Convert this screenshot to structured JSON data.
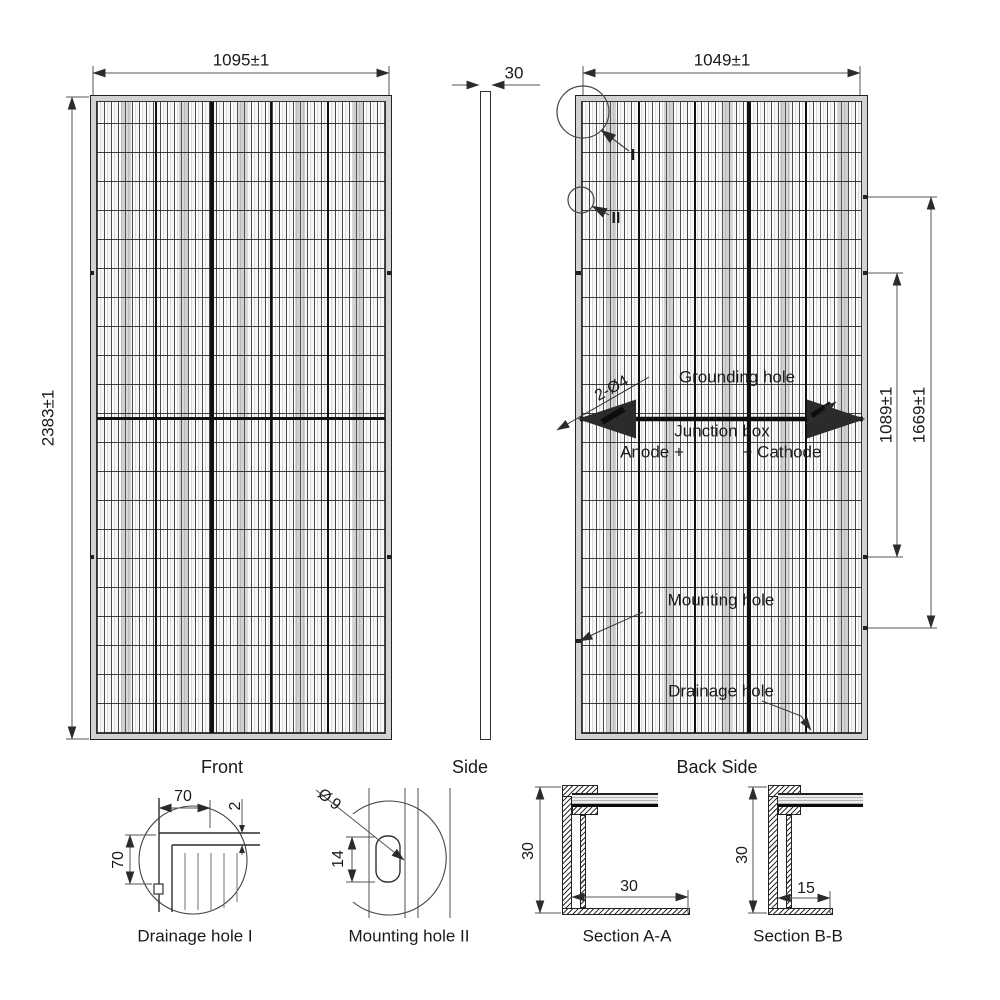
{
  "views": {
    "front": {
      "caption": "Front",
      "width_dim": "1095±1",
      "height_dim": "2383±1"
    },
    "side": {
      "caption": "Side",
      "thickness_dim": "30"
    },
    "back": {
      "caption": "Back Side",
      "width_dim": "1049±1",
      "mount_span_dim": "1089±1",
      "mount_outer_dim": "1669±1",
      "grounding_qty": "2-Ø4",
      "grounding_label": "Grounding hole",
      "junction_label": "Junction box",
      "anode_label": "Anode +",
      "cathode_label": "+ Cathode",
      "mounting_label": "Mounting hole",
      "drainage_label": "Drainage hole",
      "detail_marker_i": "I",
      "detail_marker_ii": "II"
    }
  },
  "details": {
    "drainage_hole": {
      "caption": "Drainage hole I",
      "width_dim": "70",
      "height_dim": "70",
      "gap_dim": "2"
    },
    "mounting_hole": {
      "caption": "Mounting hole II",
      "diameter_dim": "Ø9",
      "slot_dim": "14"
    },
    "section_aa": {
      "caption": "Section A-A",
      "frame_height_dim": "30",
      "flange_width_dim": "30"
    },
    "section_bb": {
      "caption": "Section B-B",
      "frame_height_dim": "30",
      "flange_width_dim": "15"
    }
  }
}
